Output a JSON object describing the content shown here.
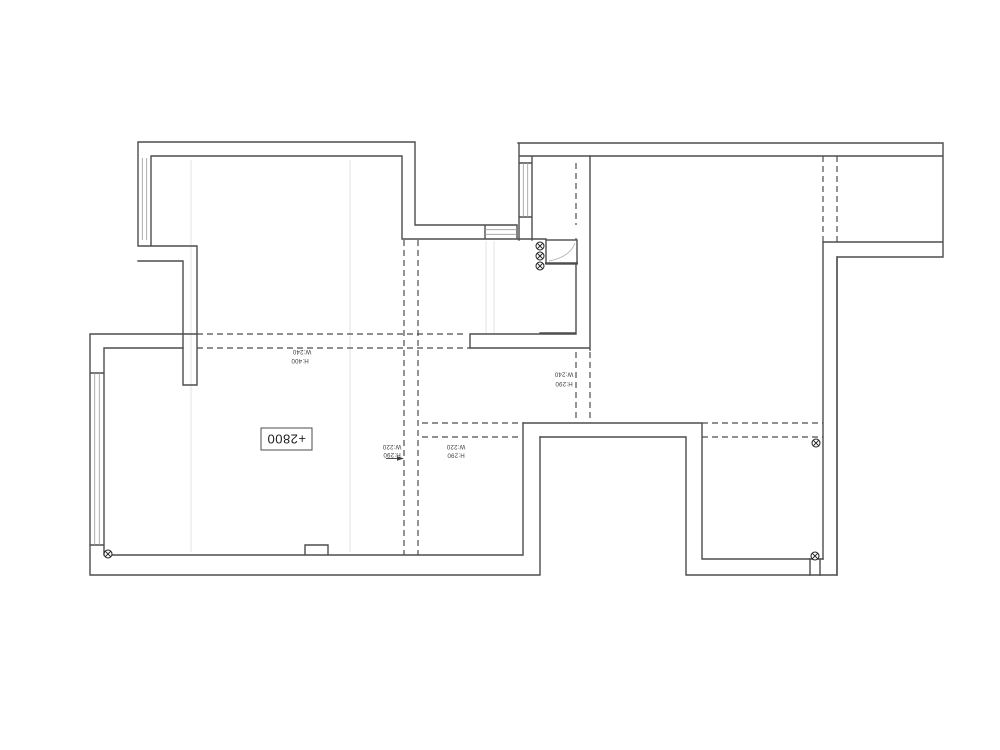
{
  "drawing": {
    "title": "apartment-floor-plan",
    "ceiling_label": "+2800",
    "beams": [
      {
        "w": "W:240",
        "h": "H:400"
      },
      {
        "w": "W:240",
        "h": "H:290"
      },
      {
        "w": "W:220",
        "h": "H:290"
      },
      {
        "w": "W:220",
        "h": "H:290"
      }
    ]
  },
  "colors": {
    "background": "#ffffff",
    "wall": "#4d4d4d",
    "beam": "#4d4d4d",
    "glazing": "#9a9a9a",
    "faint": "#dcdcdc",
    "symbol": "#1f1f1f",
    "arc": "#b5b5b5"
  }
}
